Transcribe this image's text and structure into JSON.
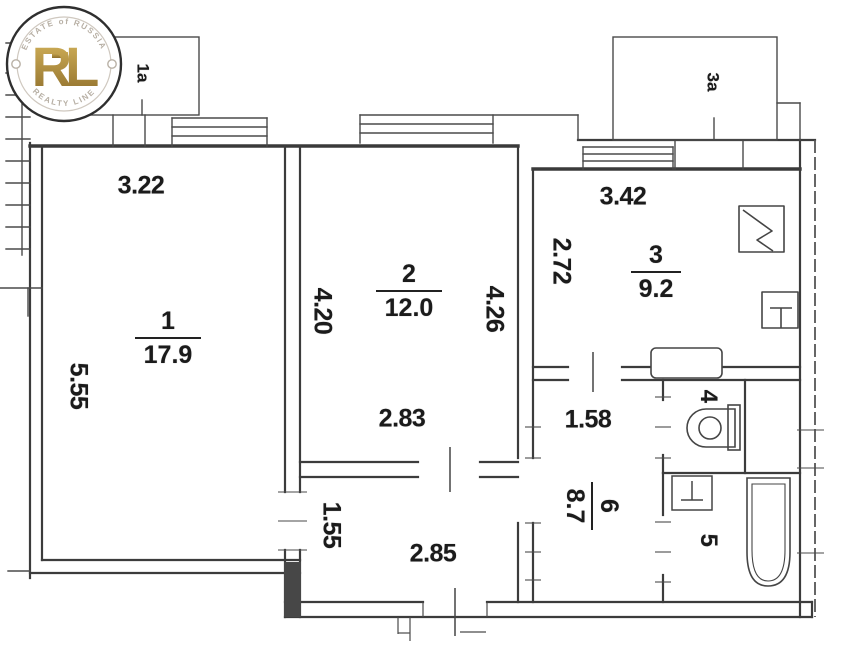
{
  "balconies": {
    "b1a": "1a",
    "b3a": "3a"
  },
  "rooms": {
    "r1": {
      "number": "1",
      "area": "17.9"
    },
    "r2": {
      "number": "2",
      "area": "12.0"
    },
    "r3": {
      "number": "3",
      "area": "9.2"
    },
    "r4": {
      "number": "4"
    },
    "r5": {
      "number": "5"
    },
    "r6": {
      "number": "6",
      "area": "8.7"
    }
  },
  "dims": {
    "d322": "3.22",
    "d555": "5.55",
    "d420": "4.20",
    "d426": "4.26",
    "d283": "2.83",
    "d272": "2.72",
    "d342": "3.42",
    "d158": "1.58",
    "d155": "1.55",
    "d285": "2.85"
  },
  "logo": {
    "arc_top": "ESTATE of RUSSIA",
    "monogram": "RL",
    "arc_bottom": "REALTY LINE",
    "gold_light": "#d6b55c",
    "gold_dark": "#8e6e2b"
  },
  "colors": {
    "line_ink": "#3c3c3c",
    "text_ink": "#1b1b1b"
  }
}
